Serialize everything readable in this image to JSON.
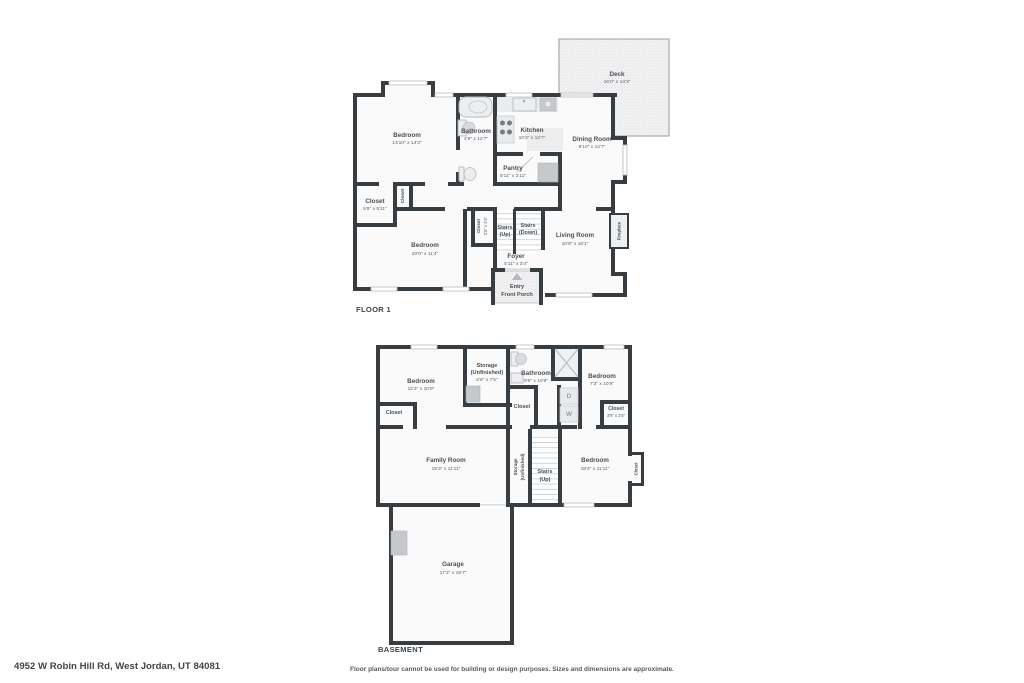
{
  "floor1": {
    "label": "FLOOR 1",
    "bedroom1": {
      "name": "Bedroom",
      "dims": "14'10\" x 14'3\""
    },
    "bathroom": {
      "name": "Bathroom",
      "dims": "4'9\" x 12'7\""
    },
    "kitchen": {
      "name": "Kitchen",
      "dims": "10'2\" x 12'7\""
    },
    "dining": {
      "name": "Dining Room",
      "dims": "8'10\" x 12'7\""
    },
    "pantry": {
      "name": "Pantry",
      "dims": "5'11\" x 2'11\""
    },
    "deck": {
      "name": "Deck",
      "dims": "16'0\" x 14'3\""
    },
    "closet1": {
      "name": "Closet",
      "dims": "5'9\" x 5'11\""
    },
    "closet2": {
      "name": "Closet"
    },
    "bedroom2": {
      "name": "Bedroom",
      "dims": "20'0\" x 11'4\""
    },
    "closet3": {
      "name": "Closet",
      "dims": "2'5\" x 4'5\""
    },
    "stairs_up": {
      "line1": "Stairs",
      "line2": "(Up)"
    },
    "stairs_down": {
      "line1": "Stairs",
      "line2": "(Down)"
    },
    "foyer": {
      "name": "Foyer",
      "dims": "5'11\" x 3'4\""
    },
    "living": {
      "name": "Living Room",
      "dims": "10'9\" x 16'1\""
    },
    "fireplace": {
      "name": "Fireplace"
    },
    "entry": {
      "line1": "Entry",
      "line2": "Front Porch"
    }
  },
  "basement": {
    "label": "BASEMENT",
    "bedroom_tl": {
      "name": "Bedroom",
      "dims": "12'4\" x 10'9\""
    },
    "storage_top": {
      "line1": "Storage",
      "line2": "(Unfinished)",
      "dims": "6'6\" x 7'5\""
    },
    "bathroom": {
      "name": "Bathroom",
      "dims": "9'5\" x 10'9\""
    },
    "bedroom_tr": {
      "name": "Bedroom",
      "dims": "7'2\" x 10'9\""
    },
    "closet_left": {
      "name": "Closet"
    },
    "closet_mid": {
      "name": "Closet"
    },
    "closet_right": {
      "name": "Closet",
      "dims": "3'9\" x 2'5\""
    },
    "family": {
      "name": "Family Room",
      "dims": "19'3\" x 11'11\""
    },
    "storage_strip": {
      "line1": "Storage",
      "line2": "(Unfinished)"
    },
    "stairs": {
      "line1": "Stairs",
      "line2": "(Up)"
    },
    "bedroom_br": {
      "name": "Bedroom",
      "dims": "18'4\" x 11'11\""
    },
    "closet_bump": {
      "name": "Closet"
    },
    "garage": {
      "name": "Garage",
      "dims": "17'2\" x 19'7\""
    },
    "dryer": "D",
    "washer": "W"
  },
  "footer": {
    "address": "4952 W Robin Hill Rd, West Jordan, UT 84081",
    "disclaimer": "Floor plans/tour cannot be used for building or design purposes. Sizes and dimensions are approximate."
  },
  "colors": {
    "wall": "#383d42",
    "floor": "#fafafa",
    "text": "#4b4f54"
  }
}
